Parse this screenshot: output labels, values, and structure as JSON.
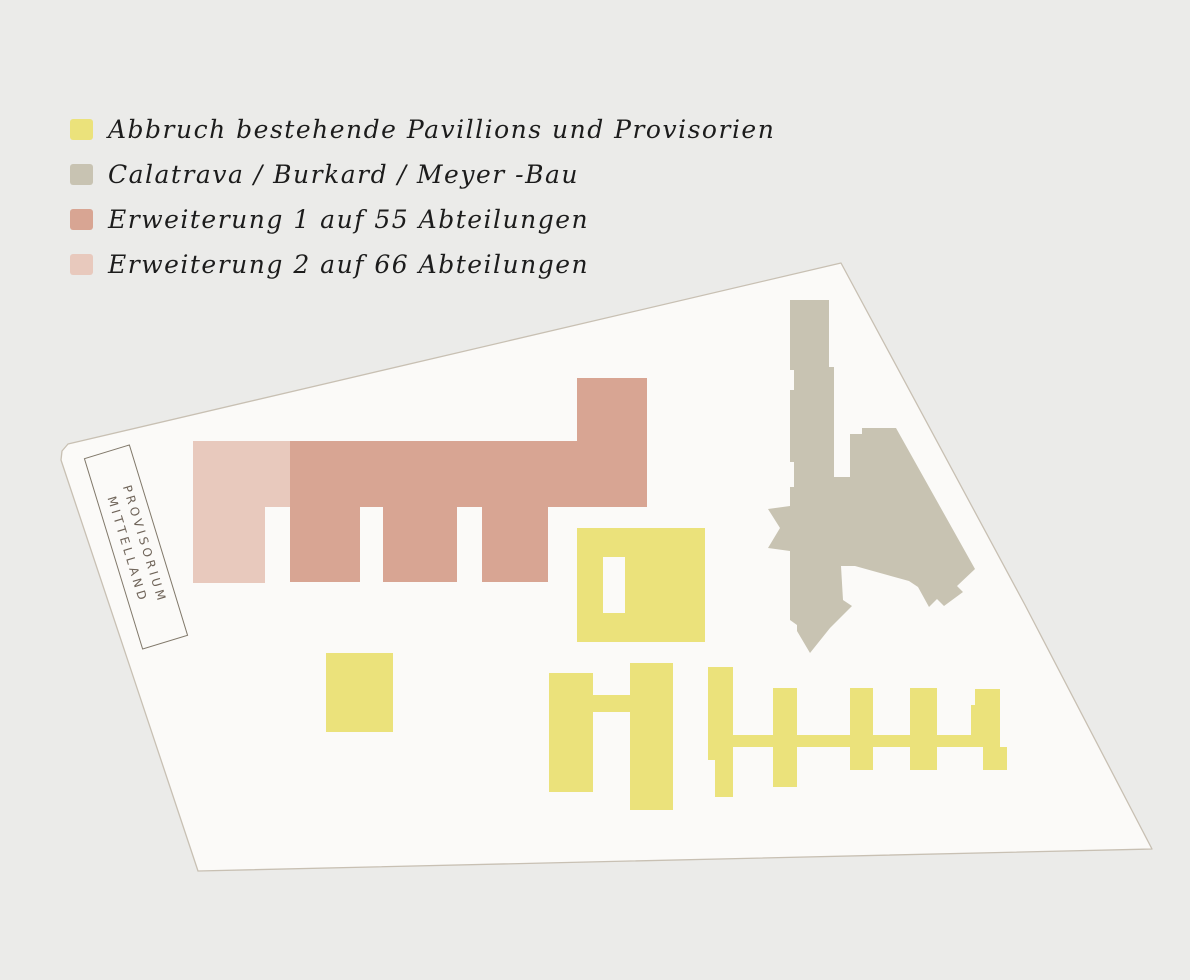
{
  "legend": {
    "items": [
      {
        "label": "Abbruch bestehende Pavillions und Provisorien",
        "color_key": "abbruch"
      },
      {
        "label": "Calatrava / Burkard / Meyer -Bau",
        "color_key": "calatrava"
      },
      {
        "label": "Erweiterung 1 auf 55 Abteilungen",
        "color_key": "erweiterung1"
      },
      {
        "label": "Erweiterung 2 auf 66 Abteilungen",
        "color_key": "erweiterung2"
      }
    ]
  },
  "site_label": {
    "line1": "PROVISORIUM",
    "line2": "MITTELLAND"
  },
  "colors": {
    "page_bg": "#ebebe9",
    "site_fill": "#fbfaf8",
    "site_border": "#c8c0b3",
    "abbruch": "#ebe27b",
    "calatrava": "#c8c3b2",
    "erweiterung1": "#d8a593",
    "erweiterung2": "#e8c9bd",
    "legend_text": "#1c1c1c",
    "label_text": "#6f6459",
    "label_border": "#80786a"
  }
}
